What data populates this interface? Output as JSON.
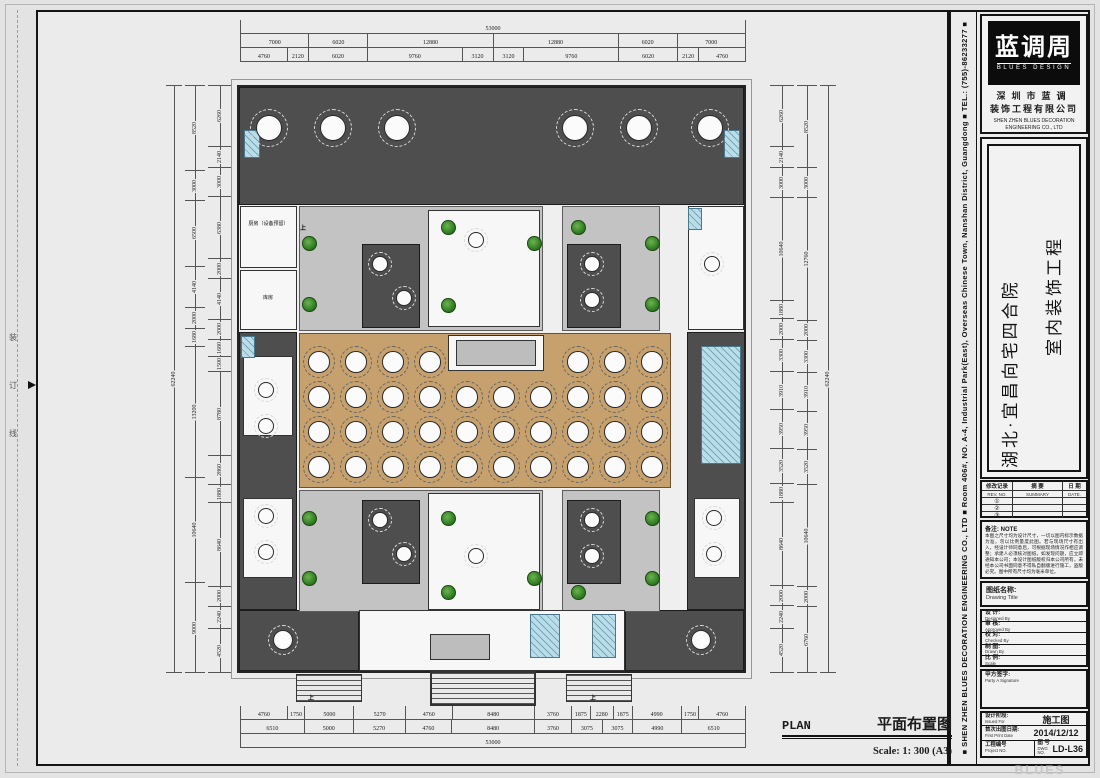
{
  "sheet": {
    "binding_chars": [
      "装",
      "订",
      "线"
    ],
    "side_strip_text": "■ SHEN ZHEN BLUES DECORATION ENGINEERING CO., LTD ■ Room 406#, NO. A-4, Industrial Park(East), Overseas Chinese Town, Nanshan District, Guangdong ■ TEL.: (755)-86233277 ■",
    "watermark": "BLUES DESIGN"
  },
  "title_block": {
    "logo": {
      "brand_cn": "蓝调周",
      "brand_en": "BLUES DESIGN",
      "company_cn_line1": "深圳市蓝调",
      "company_cn_line2": "装饰工程有限公司",
      "company_en_line1": "SHEN ZHEN BLUES DECORATION",
      "company_en_line2": "ENGINEERING CO., LTD"
    },
    "project_title": {
      "line1": "湖北·宜昌向宅四合院",
      "line2": "室内装饰工程"
    },
    "revision_table": {
      "headers_cn": [
        "修改记录",
        "摘 要",
        "日 期"
      ],
      "headers_en": [
        "REV. NO.",
        "SUMMARY",
        "DATE."
      ],
      "rows": [
        "①",
        "②",
        "③"
      ]
    },
    "notes": {
      "label": "备注: NOTE",
      "text": "本图之尺寸均为设计尺寸，一切以图内标示数据为准，勿以比例量度此图。若与现场尺寸有出入，经设计师同意后，可根据现场情况作相应调整；承建人必须核对图纸，如发现问题，应立即通知本公司；本设计图纸版权归本公司所有，未经本公司书面同意不得私自翻版进行施工，盗版必究。图中所有尺寸均为毫米单位。"
    },
    "drawing_title_label": {
      "cn": "图纸名称:",
      "en": "Drawing Title"
    },
    "sign_rows": [
      {
        "cn": "设 计:",
        "en": "Designed By"
      },
      {
        "cn": "审 核:",
        "en": "Approved By"
      },
      {
        "cn": "校 对:",
        "en": "Checked By"
      },
      {
        "cn": "制 图:",
        "en": "Drawn By"
      },
      {
        "cn": "比 例:",
        "en": "Scale"
      }
    ],
    "party_sign": {
      "cn": "甲方签字:",
      "en": "Party A Signature"
    },
    "issue": {
      "stage_cn": "设计阶段:",
      "stage_en": "Issued For",
      "stage_value": "施工图",
      "date_cn": "首次出图日期:",
      "date_en": "First Print Date",
      "date_value": "2014/12/12",
      "project_no_cn": "工程编号",
      "project_no_en": "Project NO.",
      "dwg_cn": "图 号",
      "dwg_en": "DWG NO.",
      "dwg_value": "LD-L36"
    }
  },
  "footer": {
    "plan_en": "PLAN",
    "plan_cn": "平面布置图",
    "scale": "Scale: 1: 300 (A3)"
  },
  "plan": {
    "labels": {
      "kitchen": "厨房（设备预留）",
      "storage": "库房",
      "up": "上"
    },
    "colors": {
      "wall": "#4e4e4e",
      "hall": "#c6a06d",
      "courtyard": "#c3c3c3",
      "wet_area": "#b9dde9",
      "plant": "#2f7a22"
    }
  },
  "dimensions": {
    "top": {
      "row1": [
        "53000"
      ],
      "row2": [
        "7000",
        "6020",
        "12880",
        "12880",
        "6020",
        "7000"
      ],
      "row3": [
        "4760",
        "2120",
        "6020",
        "9760",
        "3120",
        "3120",
        "9760",
        "6020",
        "2120",
        "4760"
      ]
    },
    "bottom": {
      "row1": [
        "4760",
        "1750",
        "5000",
        "5270",
        "4760",
        "8480",
        "3760",
        "1875",
        "2280",
        "1875",
        "4990",
        "1750",
        "4760"
      ],
      "row2": [
        "6510",
        "5000",
        "5270",
        "4760",
        "8480",
        "3760",
        "3075",
        "3075",
        "4990",
        "6510"
      ],
      "row3": [
        "53000"
      ]
    },
    "left": {
      "total": [
        "62240"
      ],
      "outer": [
        "8520",
        "3000",
        "6500",
        "4140",
        "2000",
        "1680",
        "13200",
        "10640",
        "9000"
      ],
      "inner": [
        "6260",
        "2140",
        "3000",
        "6380",
        "2000",
        "4140",
        "2000",
        "1680",
        "1500",
        "8780",
        "2860",
        "1880",
        "8640",
        "2000",
        "2240",
        "4520"
      ]
    },
    "right": {
      "inner": [
        "6260",
        "2140",
        "3000",
        "10640",
        "1880",
        "2000",
        "3300",
        "3910",
        "3950",
        "3520",
        "1880",
        "8640",
        "2000",
        "2240",
        "4520"
      ],
      "middle": [
        "8520",
        "3000",
        "12760",
        "2000",
        "3300",
        "3910",
        "3950",
        "3520",
        "10640",
        "2000",
        "6760"
      ],
      "total": [
        "62240"
      ]
    }
  }
}
